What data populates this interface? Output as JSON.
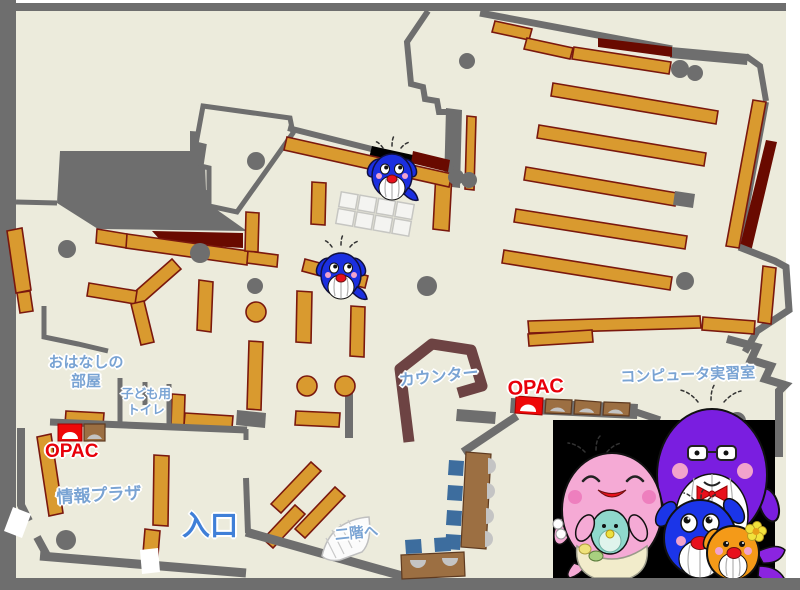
{
  "map": {
    "title": "library-first-floor-map",
    "labels": {
      "storytelling_room": "おはなしの\n部屋",
      "kids_toilet": "子ども用\nトイレ",
      "opac_left": "OPAC",
      "info_plaza": "情報プラザ",
      "entrance": "入口",
      "counter": "カウンター",
      "opac_right": "OPAC",
      "computer_room": "コンピュータ実習室",
      "to_second_floor": "二階へ"
    },
    "colors": {
      "floor": "#ECEBDC",
      "wall": "#6E6E6E",
      "shelf": "#D99A2F",
      "shelf_border": "#7A180E",
      "dark_red": "#690A00",
      "counter": "#6D4343",
      "desk": "#9C6F42",
      "chair": "#3D6D9E",
      "monitor_gray": "#C4C4C4",
      "label_blue": "#79A3D3",
      "entrance_blue": "#3F7FD8",
      "opac_red": "#E8000A",
      "panel_black": "#000000",
      "whale_blue": "#1B2FE0",
      "whale_purple": "#7A1EE0",
      "whale_pink": "#F5AAD5",
      "whale_orange": "#F49A18",
      "whale_teal": "#8FD8CC",
      "apron_cream": "#F2ECCB"
    },
    "mascots": {
      "map_whale_count": 2,
      "family": [
        "mother-pink-whale",
        "baby-teal-whale",
        "child-blue-whale",
        "father-purple-whale",
        "child-orange-whale"
      ]
    }
  }
}
